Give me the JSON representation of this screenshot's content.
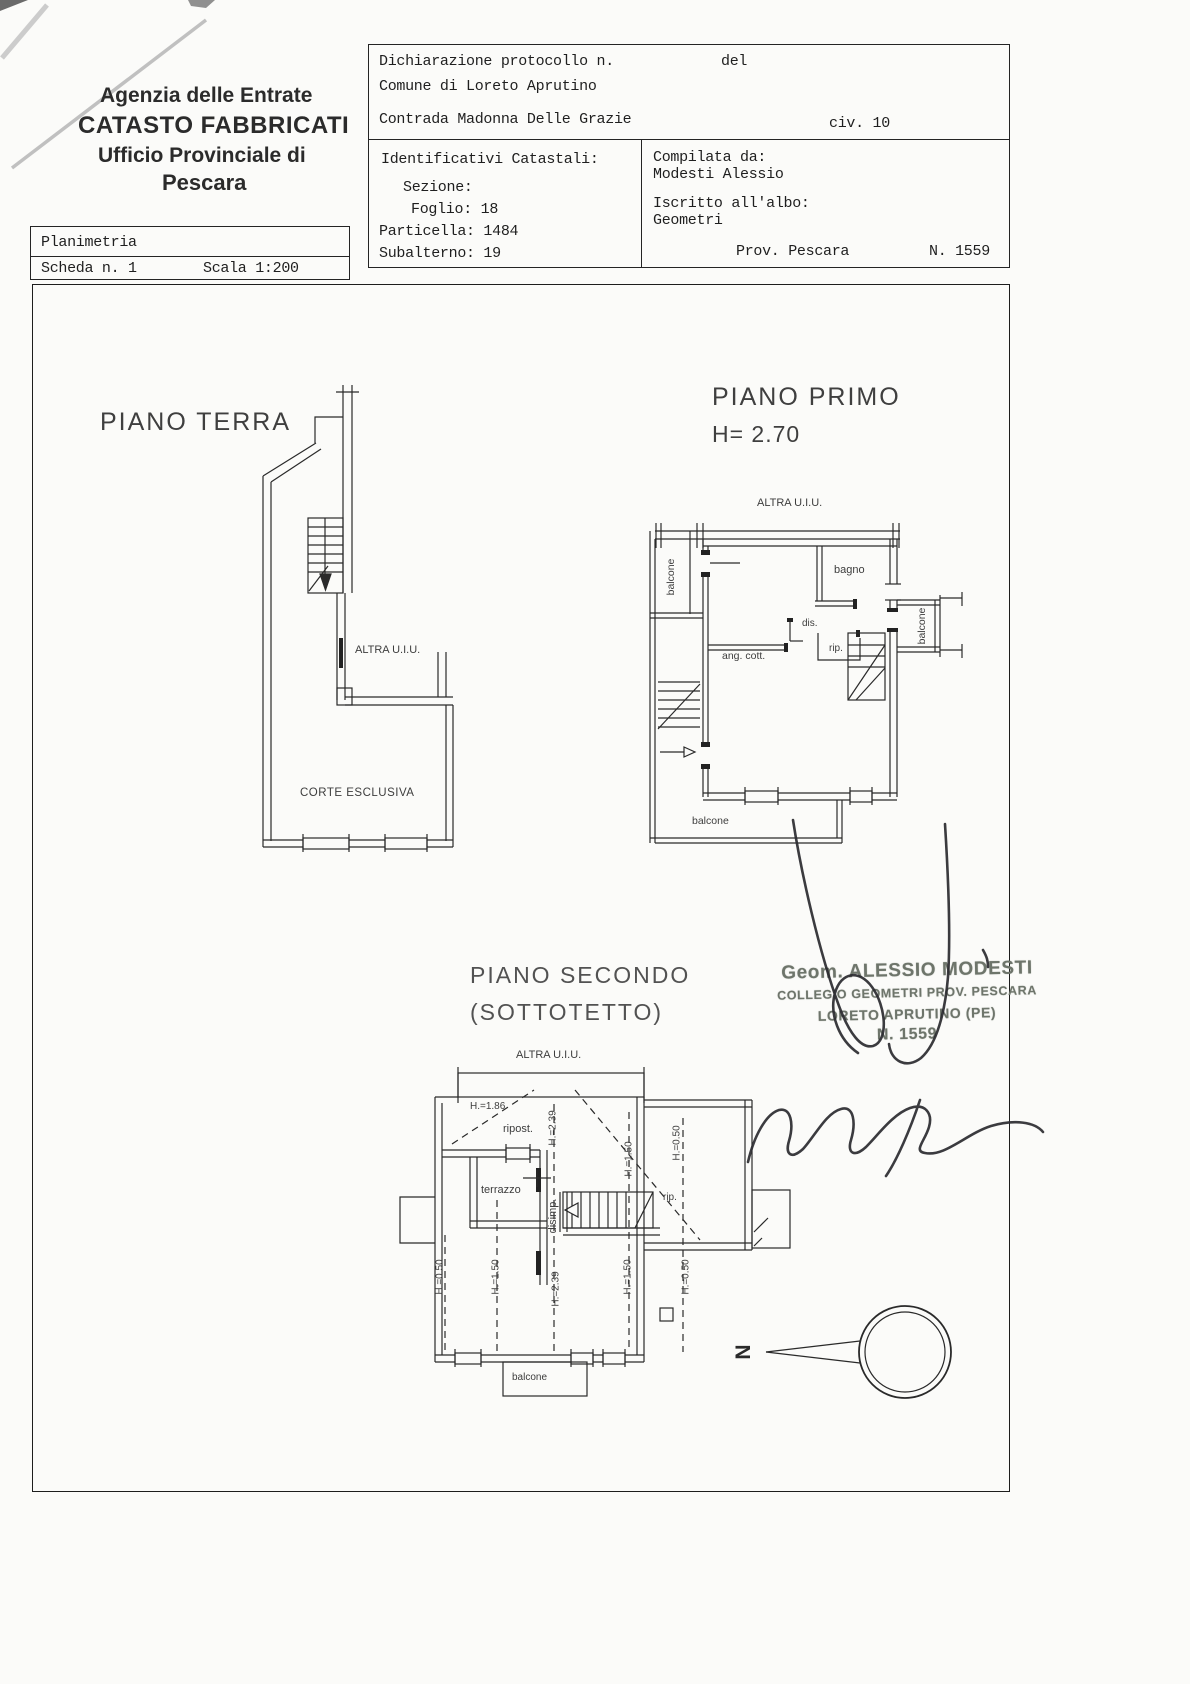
{
  "document": {
    "header": {
      "line1": "Agenzia delle Entrate",
      "line2": "CATASTO FABBRICATI",
      "line3": "Ufficio Provinciale di",
      "line4": "Pescara"
    },
    "planimetria_box": {
      "row1": "Planimetria",
      "sheet": "Scheda n. 1",
      "scale": "Scala 1:200"
    },
    "declaration": {
      "protocol_label": "Dichiarazione protocollo n.",
      "del_label": "del",
      "comune": "Comune di Loreto Aprutino",
      "street": "Contrada Madonna Delle Grazie",
      "civic": "civ. 10"
    },
    "cadastral_ids": {
      "title": "Identificativi Catastali:",
      "sezione": "Sezione:",
      "foglio": "Foglio: 18",
      "particella": "Particella: 1484",
      "subalterno": "Subalterno: 19"
    },
    "compiler": {
      "label": "Compilata da:",
      "name": "Modesti Alessio",
      "register_label": "Iscritto all'albo:",
      "register": "Geometri",
      "province": "Prov. Pescara",
      "number": "N. 1559"
    }
  },
  "plans": {
    "piano_terra": {
      "title": "PIANO TERRA",
      "altra_uiu": "ALTRA U.I.U.",
      "corte_esclusiva": "CORTE ESCLUSIVA"
    },
    "piano_primo": {
      "title": "PIANO PRIMO",
      "height": "H= 2.70",
      "altra_uiu": "ALTRA U.I.U.",
      "balcone_left": "balcone",
      "bagno": "bagno",
      "dis": "dis.",
      "rip": "rip.",
      "ang_cott": "ang. cott.",
      "balcone_right": "balcone",
      "balcone_bottom": "balcone"
    },
    "piano_secondo": {
      "title": "PIANO SECONDO",
      "subtitle": "(SOTTOTETTO)",
      "altra_uiu": "ALTRA U.I.U.",
      "h_186": "H.=1.86",
      "ripost": "ripost.",
      "h_239_upper": "H.=2.39",
      "h_150_upper": "H.=1.50",
      "h_050_upper": "H.=0.50",
      "terrazzo": "terrazzo",
      "disimp": "disimp.",
      "rip": "rip.",
      "h_050_left": "H.=0.50",
      "h_150_left": "H.=1.50",
      "h_239_center": "H.=2.39",
      "h_150_right": "H.=1.50",
      "h_050_right": "H.=0.50",
      "balcone": "balcone"
    }
  },
  "stamp": {
    "line1": "Geom. ALESSIO MODESTI",
    "line2": "COLLEGIO GEOMETRI PROV. PESCARA",
    "line3": "LORETO APRUTINO (PE)",
    "line4": "N. 1559"
  },
  "compass": {
    "north": "N"
  },
  "colors": {
    "ink": "#222222",
    "stamp": "#6e756b",
    "paper": "#fbfbf9"
  }
}
